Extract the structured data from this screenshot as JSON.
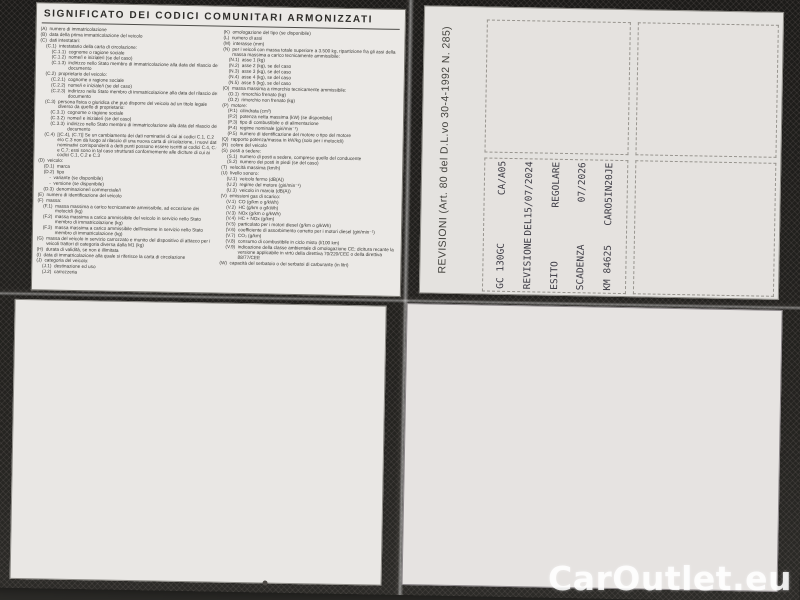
{
  "page": {
    "header": "SIGNIFICATO DEI CODICI COMUNITARI ARMONIZZATI",
    "revision_caption": "REVISIONI (Art. 80 del D.L.vo 30-4-1992 N. 285)",
    "watermark": "CarOutlet.eu"
  },
  "colors": {
    "paper": "#e6e4e1",
    "ink": "#3b3a36",
    "stamp_ink": "#3e3d46",
    "photo_background": "#232220",
    "watermark": "#ffffff"
  },
  "codes": {
    "col1": [
      [
        "(A)",
        "numero di immatricolazione",
        0
      ],
      [
        "(B)",
        "data della prima immatricolazione del veicolo",
        0
      ],
      [
        "(C)",
        "dati intestatari:",
        0
      ],
      [
        "(C.1)",
        "intestatario della carta di circolazione:",
        1
      ],
      [
        "(C.1.1)",
        "cognome o ragione sociale",
        2
      ],
      [
        "(C.1.2)",
        "nome/i e iniziale/i (se del caso)",
        2
      ],
      [
        "(C.1.3)",
        "indirizzo nello Stato membro di immatricolazione alla data del rilascio del documento",
        2
      ],
      [
        "(C.2)",
        "proprietario del veicolo:",
        1
      ],
      [
        "(C.2.1)",
        "cognome o ragione sociale",
        2
      ],
      [
        "(C.2.2)",
        "nome/i e iniziale/i (se del caso)",
        2
      ],
      [
        "(C.2.3)",
        "indirizzo nello Stato membro di immatricolazione alla data del rilascio del documento",
        2
      ],
      [
        "(C.3)",
        "persona fisica o giuridica che può disporre del veicolo ad un titolo legale diverso da quello di proprietario:",
        1
      ],
      [
        "(C.3.1)",
        "cognome o ragione sociale",
        2
      ],
      [
        "(C.3.2)",
        "nome/i e iniziale/i (se del caso)",
        2
      ],
      [
        "(C.3.3)",
        "indirizzo nello Stato membro di immatricolazione alla data del rilascio del documento",
        2
      ],
      [
        "(C.4)",
        "[(C.4), (C.7)] Se un cambiamento dei dati nominativi di cui ai codici C.1, C.2 e/o C.3 non dà luogo al rilascio di una nuova carta di circolazione, i nuovi dati nominativi corrispondenti a detti punti possono essere iscritti ai codici C.4, C.6 e C.7; essi sono in tal caso strutturati conformemente alle diciture di cui ai codici C.1, C.2 e C.3",
        1
      ],
      [
        "(D)",
        "veicolo:",
        0
      ],
      [
        "(D.1)",
        "marca",
        1
      ],
      [
        "(D.2)",
        "tipo",
        1
      ],
      [
        "-",
        "variante (se disponibile)",
        2
      ],
      [
        "-",
        "versione (se disponibile)",
        2
      ],
      [
        "(D.3)",
        "denominazione/i commerciale/i",
        1
      ],
      [
        "(E)",
        "numero di identificazione del veicolo",
        0
      ],
      [
        "(F)",
        "massa:",
        0
      ],
      [
        "(F.1)",
        "massa massima a carico tecnicamente ammissibile, ad eccezione dei motocicli (kg)",
        1
      ],
      [
        "(F.2)",
        "massa massima a carico ammissibile del veicolo in servizio nello Stato membro di immatricolazione (kg)",
        1
      ],
      [
        "(F.3)",
        "massa massima a carico ammissibile dell'insieme in servizio nello Stato membro di immatricolazione (kg)",
        1
      ],
      [
        "(G)",
        "massa del veicolo in servizio carrozzato e munito del dispositivo di attacco per i veicoli trattori di categoria diversa dalla M1 (kg)",
        0
      ],
      [
        "(H)",
        "durata di validità, se non è illimitata",
        0
      ],
      [
        "(I)",
        "data di immatricolazione alla quale si riferisce la carta di circolazione",
        0
      ],
      [
        "(J)",
        "categoria del veicolo:",
        0
      ],
      [
        "(J.1)",
        "destinazione ed uso",
        1
      ],
      [
        "(J.2)",
        "carrozzeria",
        1
      ]
    ],
    "col2": [
      [
        "(K)",
        "omologazione del tipo (se disponibile)",
        0
      ],
      [
        "(L)",
        "numero di assi",
        0
      ],
      [
        "(M)",
        "interasse (mm)",
        0
      ],
      [
        "(N)",
        "per i veicoli con massa totale superiore a 3.500 kg, ripartizione fra gli assi della massa massima a carico tecnicamente ammissibile:",
        0
      ],
      [
        "(N.1)",
        "asse 1 (kg)",
        1
      ],
      [
        "(N.2)",
        "asse 2 (kg), se del caso",
        1
      ],
      [
        "(N.3)",
        "asse 3 (kg), se del caso",
        1
      ],
      [
        "(N.4)",
        "asse 4 (kg), se del caso",
        1
      ],
      [
        "(N.5)",
        "asse 5 (kg), se del caso",
        1
      ],
      [
        "(O)",
        "massa massima a rimorchio tecnicamente ammissibile:",
        0
      ],
      [
        "(O.1)",
        "rimorchio frenato (kg)",
        1
      ],
      [
        "(O.2)",
        "rimorchio non frenato (kg)",
        1
      ],
      [
        "(P)",
        "motore:",
        0
      ],
      [
        "(P.1)",
        "cilindrata (cm³)",
        1
      ],
      [
        "(P.2)",
        "potenza netta massima (kW) (se disponibile)",
        1
      ],
      [
        "(P.3)",
        "tipo di combustibile o di alimentazione",
        1
      ],
      [
        "(P.4)",
        "regime nominale (giri/min⁻¹)",
        1
      ],
      [
        "(P.5)",
        "numero di identificazione del motore o tipo del motore",
        1
      ],
      [
        "(Q)",
        "rapporto potenza/massa in kW/kg (solo per i motocicli)",
        0
      ],
      [
        "(R)",
        "colore del veicolo",
        0
      ],
      [
        "(S)",
        "posti a sedere:",
        0
      ],
      [
        "(S.1)",
        "numero di posti a sedere, compreso quello del conducente",
        1
      ],
      [
        "(S.2)",
        "numero dei posti in piedi (se del caso)",
        1
      ],
      [
        "(T)",
        "velocità massima (km/h)",
        0
      ],
      [
        "(U)",
        "livello sonoro:",
        0
      ],
      [
        "(U.1)",
        "veicolo fermo (dB(A))",
        1
      ],
      [
        "(U.2)",
        "regime del motore (giri/min⁻¹)",
        1
      ],
      [
        "(U.3)",
        "veicolo in marcia (dB(A))",
        1
      ],
      [
        "(V)",
        "emissioni gas di scarico:",
        0
      ],
      [
        "(V.1)",
        "CO (g/km o g/kWh)",
        1
      ],
      [
        "(V.2)",
        "HC (g/km o g/kWh)",
        1
      ],
      [
        "(V.3)",
        "NOx (g/km o g/kWh)",
        1
      ],
      [
        "(V.4)",
        "HC + NOx (g/km)",
        1
      ],
      [
        "(V.5)",
        "particolato per i motori diesel (g/km o g/kWh)",
        1
      ],
      [
        "(V.6)",
        "coefficiente di assorbimento corretto per i motori diesel (giri/min⁻¹)",
        1
      ],
      [
        "(V.7)",
        "CO₂ (g/km)",
        1
      ],
      [
        "(V.8)",
        "consumo di combustibile in ciclo misto (l/100 km)",
        1
      ],
      [
        "(V.9)",
        "indicazione della classe ambientale di omologazione CE; dicitura recante la versione applicabile in virtù della direttiva 70/220/CEE o della direttiva 88/77/CEE",
        1
      ],
      [
        "(W)",
        "capacità del serbatoio o dei serbatoi di carburante (in litri)",
        0
      ]
    ]
  },
  "stamp": {
    "lines": [
      {
        "label": "GC 130GC",
        "value": "CA/A05"
      },
      {
        "label": "REVISIONE",
        "value": "DEL15/07/2024"
      },
      {
        "label": "ESITO",
        "value": "REGOLARE"
      },
      {
        "label": "SCADENZA",
        "value": "07/2026"
      },
      {
        "label": "KM 84625",
        "value": "CARO5IN20JE"
      }
    ]
  }
}
